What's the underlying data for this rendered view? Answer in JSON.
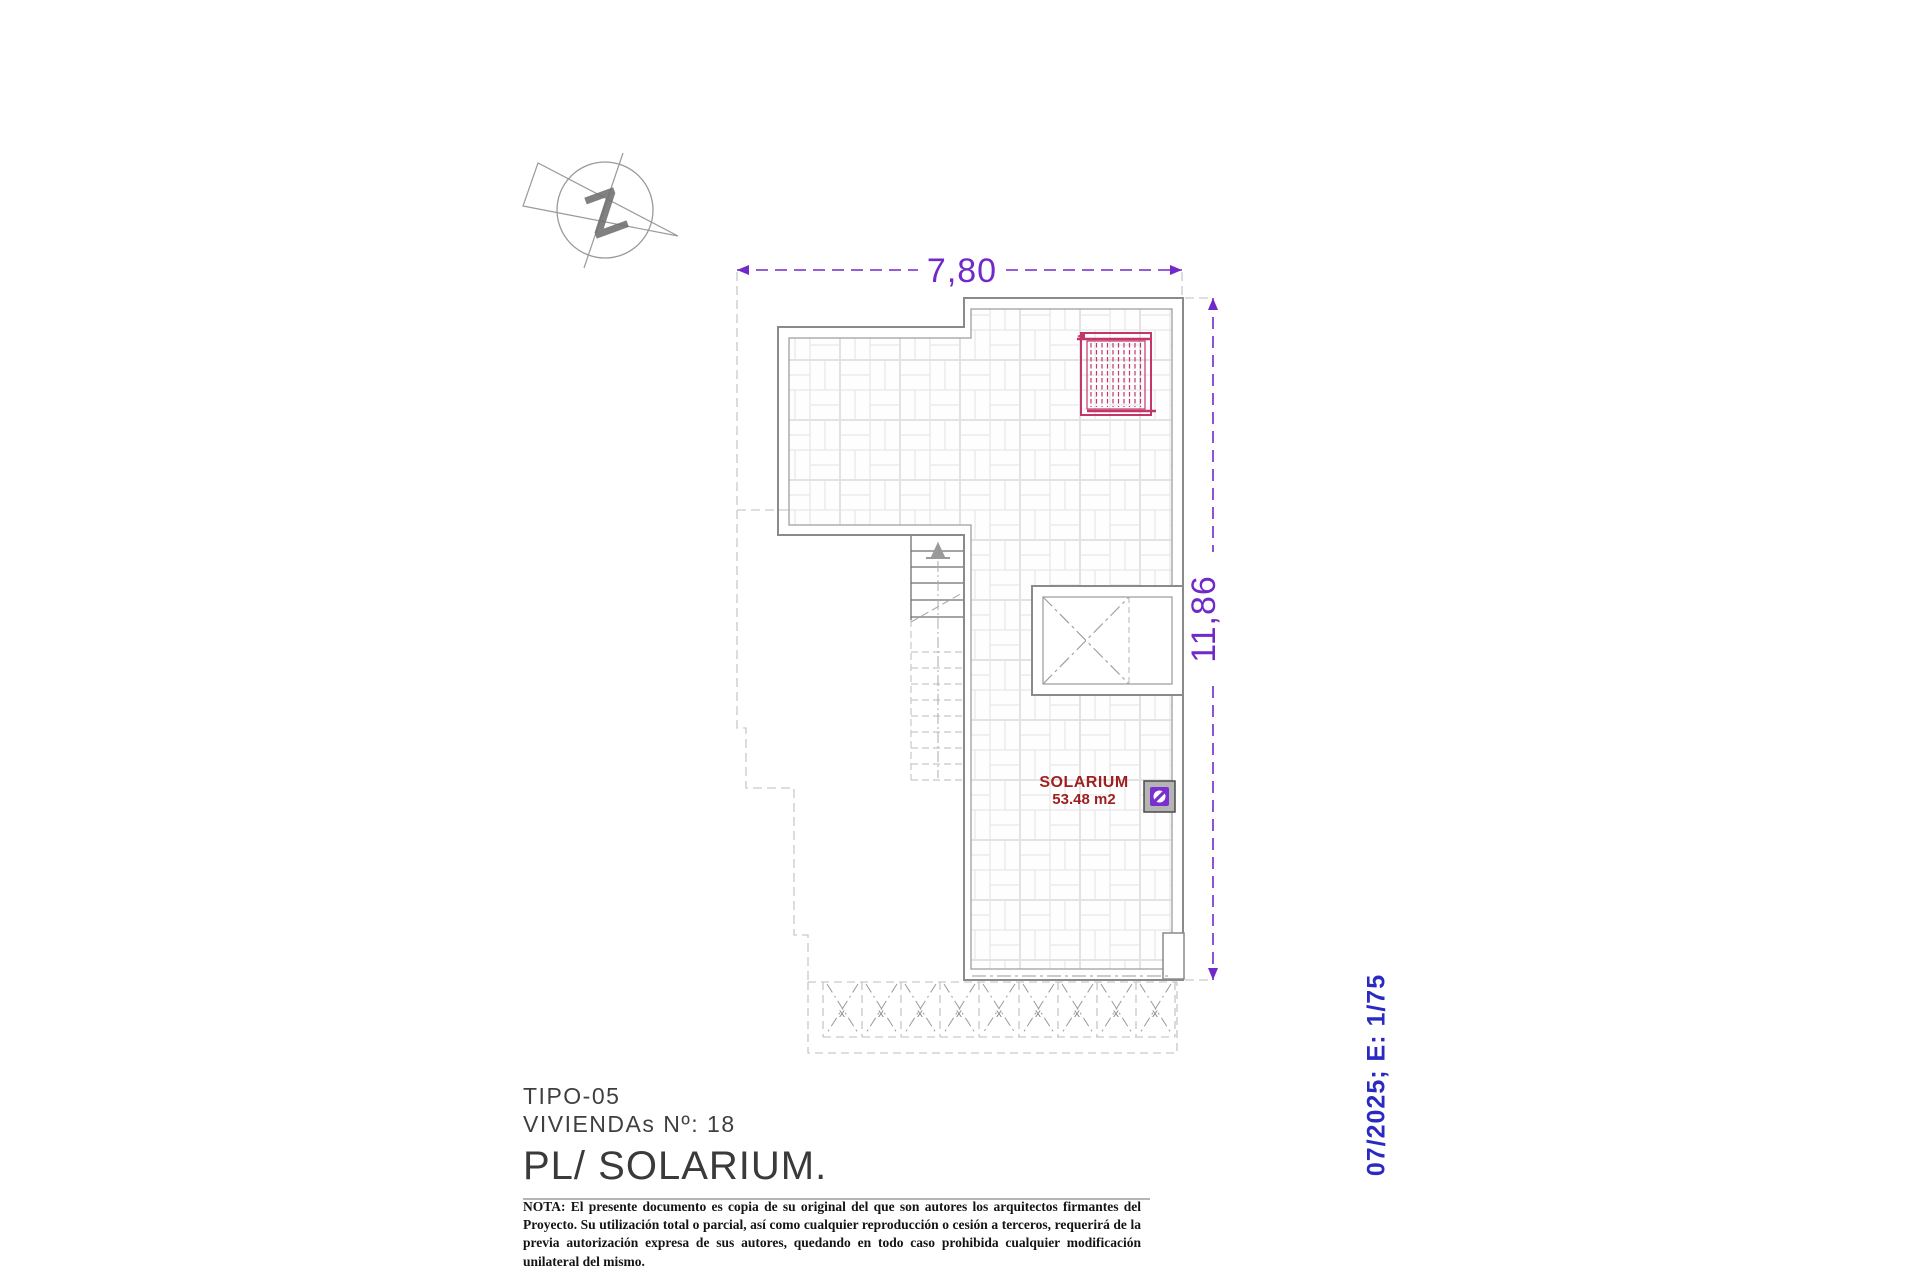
{
  "plan": {
    "room_label": "SOLARIUM",
    "room_area": "53.48 m2",
    "pergola_x_mark": "x",
    "north_letter": "Z"
  },
  "dimensions": {
    "width_label": "7,80",
    "height_label": "11,86"
  },
  "title_block": {
    "type_line": "TIPO-05",
    "viviendas_line": "VIVIENDAs Nº: 18",
    "plan_title": "PL/ SOLARIUM.",
    "note": "NOTA: El presente documento es copia de su original del que son autores los arquitectos firmantes del Proyecto. Su utilización total o parcial, así como cualquier reproducción o cesión a terceros, requerirá  de la previa autorización expresa de sus autores, quedando en todo caso prohibida cualquier modificación unilateral del mismo."
  },
  "stamp": {
    "date_scale": "07/2025; E: 1/75"
  },
  "colors": {
    "dimension": "#7229c9",
    "panel": "#c4366a",
    "room_text": "#9e1f1f",
    "stamp_text": "#2a2ac2",
    "wall": "#8a8a8a"
  }
}
